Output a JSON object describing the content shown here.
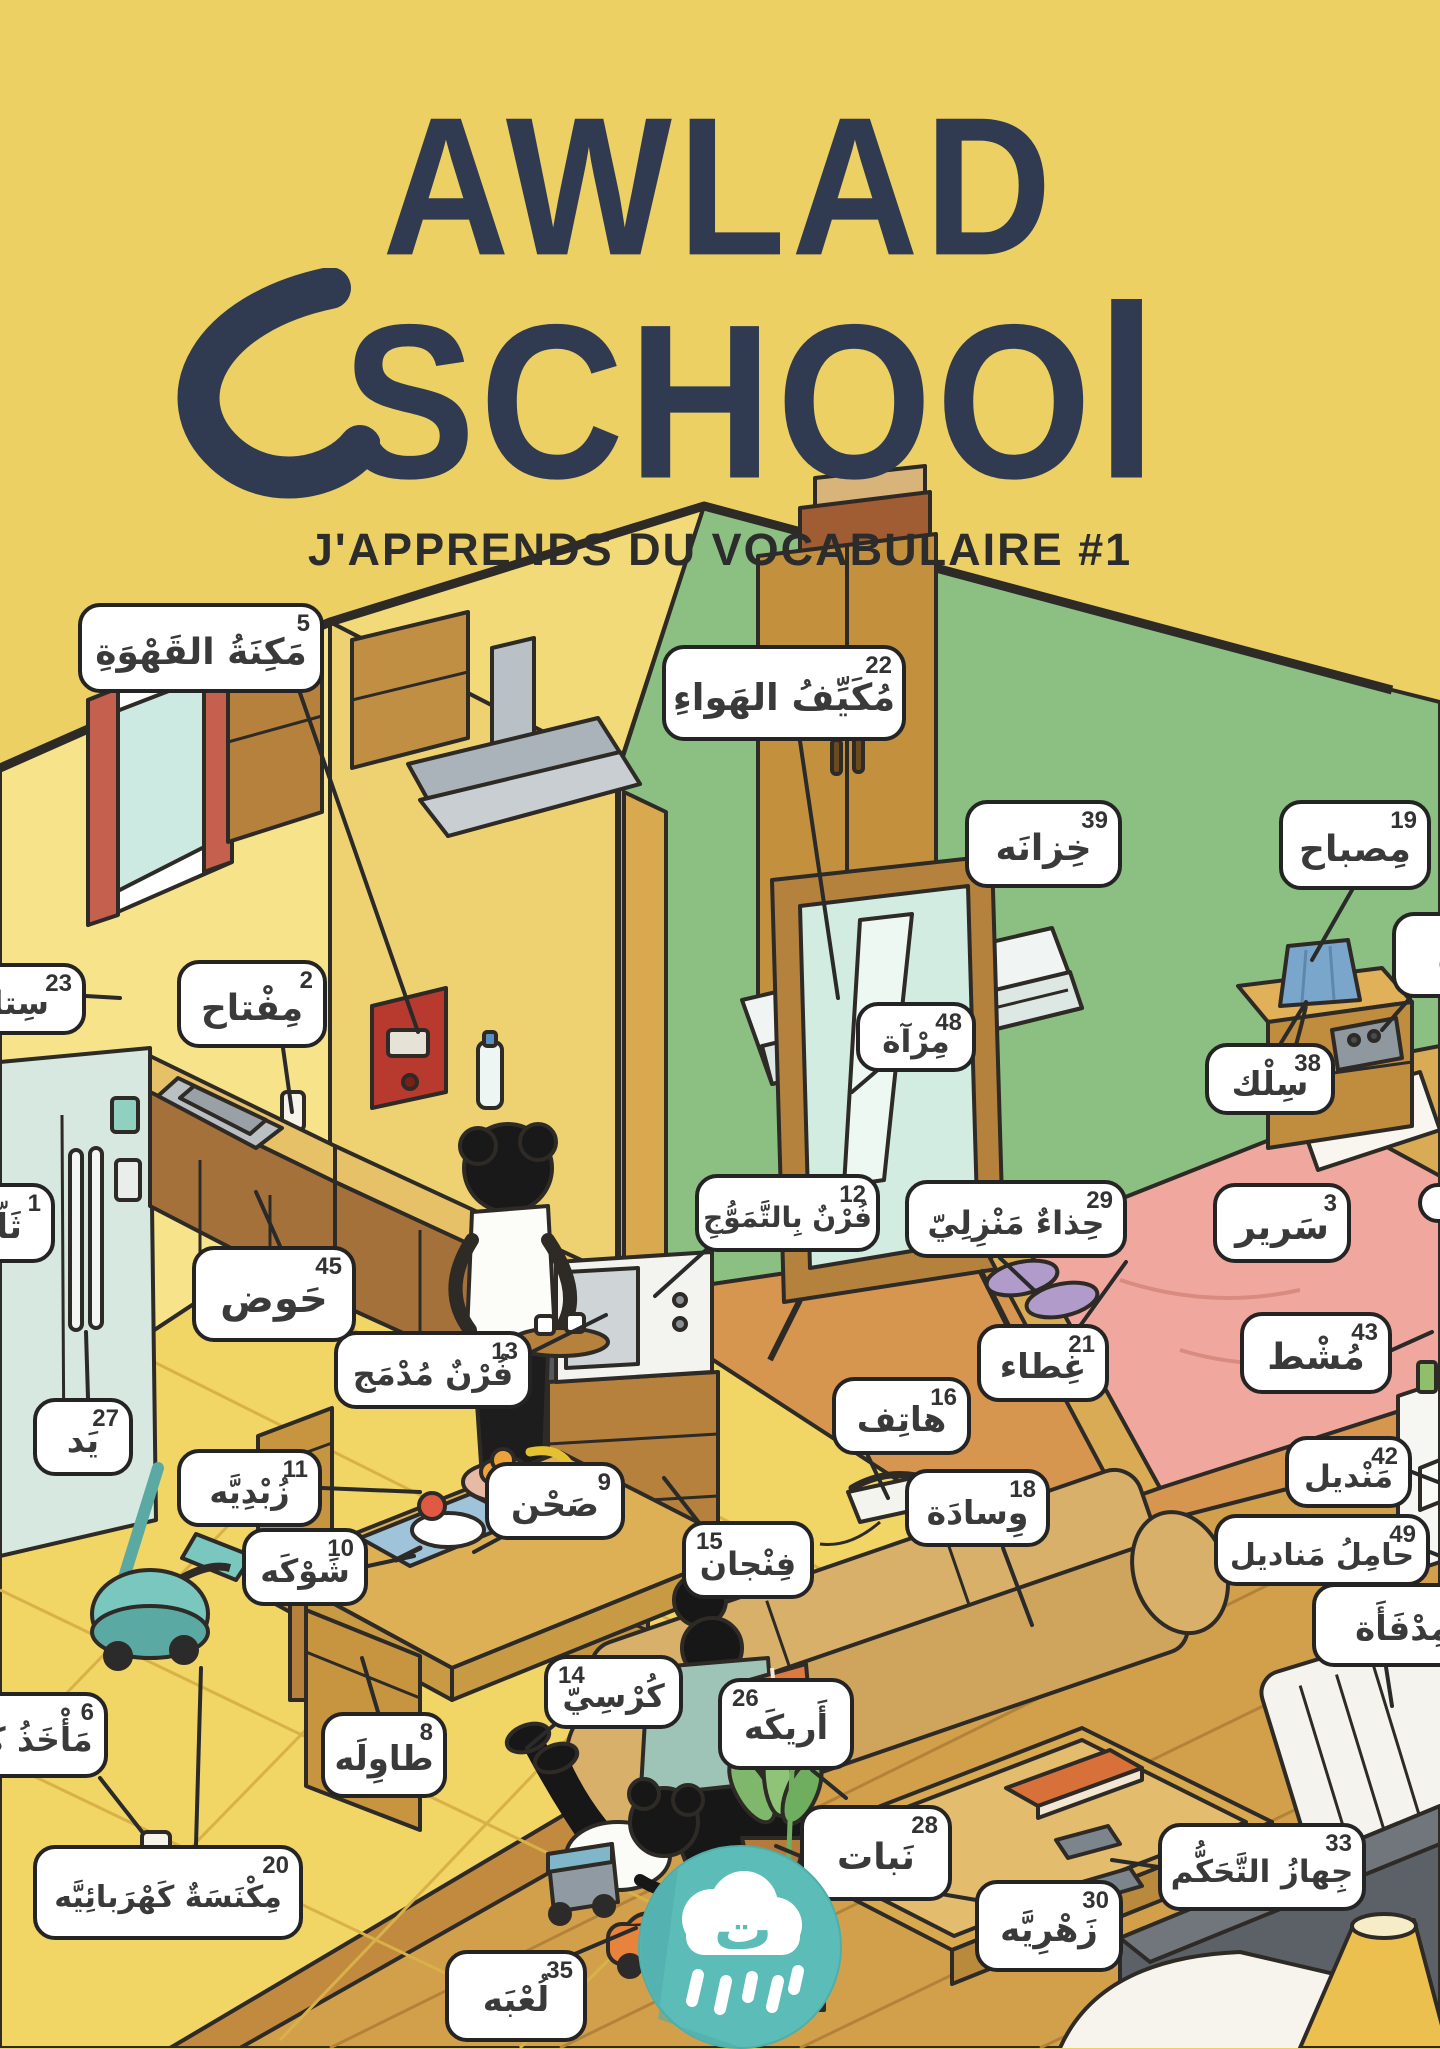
{
  "title": {
    "line1": "AWLAD",
    "line2_prefix": "SCHOO",
    "line2_suffix": "l"
  },
  "subtitle": "J'APPRENDS DU VOCABULAIRE #1",
  "colors": {
    "background": "#ecd063",
    "title_text": "#303b52",
    "green_wall": "#8cbf82",
    "kitchen_wall": "#f7e38a",
    "wood_floor": "#d2a04b",
    "label_bg": "#ffffff",
    "label_border": "#242424",
    "logo_teal": "#5cbcb8"
  },
  "logo": {
    "letter": "ت",
    "icon": "cloud-rain-icon"
  },
  "labels": [
    {
      "name": "fridge",
      "num": "1",
      "text": "ثَلّاجَة",
      "x": -95,
      "y": 1183,
      "w": 150,
      "h": 80,
      "numSide": "right",
      "cut": "left",
      "fs": 34,
      "line": null
    },
    {
      "name": "key",
      "num": "2",
      "text": "مِفْتاح",
      "x": 177,
      "y": 960,
      "w": 150,
      "h": 88,
      "numSide": "right",
      "cut": null,
      "fs": 36,
      "line": [
        283,
        1048,
        292,
        1112
      ]
    },
    {
      "name": "bed",
      "num": "3",
      "text": "سَرير",
      "x": 1213,
      "y": 1183,
      "w": 138,
      "h": 80,
      "numSide": "right",
      "cut": null,
      "fs": 36,
      "line": null
    },
    {
      "name": "coffee-machine",
      "num": "5",
      "text": "مَكِنَةُ القَهْوَةِ",
      "x": 78,
      "y": 603,
      "w": 246,
      "h": 90,
      "numSide": "right",
      "cut": null,
      "fs": 36,
      "line": [
        300,
        693,
        418,
        1032
      ]
    },
    {
      "name": "outlet",
      "num": "6",
      "text": "مَأْخَذُ كَهْـ",
      "x": -62,
      "y": 1692,
      "w": 170,
      "h": 86,
      "numSide": "right",
      "cut": "left",
      "fs": 33,
      "line": [
        100,
        1778,
        143,
        1833
      ]
    },
    {
      "name": "table",
      "num": "8",
      "text": "طاوِلَه",
      "x": 321,
      "y": 1712,
      "w": 126,
      "h": 86,
      "numSide": "right",
      "cut": null,
      "fs": 34,
      "line": [
        378,
        1712,
        362,
        1658
      ]
    },
    {
      "name": "plate",
      "num": "9",
      "text": "صَحْن",
      "x": 485,
      "y": 1462,
      "w": 140,
      "h": 78,
      "numSide": "right",
      "cut": null,
      "fs": 34,
      "line": [
        500,
        1538,
        474,
        1552
      ]
    },
    {
      "name": "fork",
      "num": "10",
      "text": "شَوْكَه",
      "x": 242,
      "y": 1528,
      "w": 126,
      "h": 78,
      "numSide": "right",
      "cut": null,
      "fs": 32,
      "line": [
        368,
        1566,
        414,
        1556
      ]
    },
    {
      "name": "bowl",
      "num": "11",
      "text": "زُبْدِيَّه",
      "x": 177,
      "y": 1449,
      "w": 145,
      "h": 78,
      "numSide": "right",
      "cut": null,
      "fs": 32,
      "line": [
        322,
        1488,
        420,
        1492
      ]
    },
    {
      "name": "microwave-oven",
      "num": "12",
      "text": "فُرْنٌ بِالتَّمَوُّجِ",
      "x": 695,
      "y": 1174,
      "w": 185,
      "h": 78,
      "numSide": "right",
      "cut": null,
      "fs": 28,
      "line": [
        706,
        1250,
        655,
        1296
      ]
    },
    {
      "name": "built-in-oven",
      "num": "13",
      "text": "فُرْنٌ مُدْمَج",
      "x": 334,
      "y": 1331,
      "w": 198,
      "h": 78,
      "numSide": "right",
      "cut": null,
      "fs": 32,
      "line": [
        532,
        1352,
        606,
        1315
      ]
    },
    {
      "name": "chair",
      "num": "14",
      "text": "كُرْسِيّ",
      "x": 544,
      "y": 1655,
      "w": 139,
      "h": 74,
      "numSide": "left",
      "cut": null,
      "fs": 32,
      "line": [
        560,
        1720,
        527,
        1748
      ]
    },
    {
      "name": "cup",
      "num": "15",
      "text": "فِنْجان",
      "x": 682,
      "y": 1521,
      "w": 132,
      "h": 78,
      "numSide": "left",
      "cut": null,
      "fs": 32,
      "line": [
        700,
        1524,
        664,
        1478
      ]
    },
    {
      "name": "phone",
      "num": "16",
      "text": "هاتِف",
      "x": 832,
      "y": 1377,
      "w": 139,
      "h": 78,
      "numSide": "right",
      "cut": null,
      "fs": 34,
      "line": [
        868,
        1456,
        888,
        1498
      ]
    },
    {
      "name": "pillow",
      "num": "18",
      "text": "وِسادَة",
      "x": 905,
      "y": 1469,
      "w": 145,
      "h": 78,
      "numSide": "right",
      "cut": null,
      "fs": 33,
      "line": [
        1003,
        1548,
        1032,
        1625
      ]
    },
    {
      "name": "lamp",
      "num": "19",
      "text": "مِصباح",
      "x": 1279,
      "y": 800,
      "w": 152,
      "h": 90,
      "numSide": "right",
      "cut": null,
      "fs": 36,
      "line": [
        1352,
        890,
        1312,
        960
      ]
    },
    {
      "name": "vacuum-cleaner",
      "num": "20",
      "text": "مِكْنَسَةٌ كَهْرَبائِيَّه",
      "x": 33,
      "y": 1845,
      "w": 270,
      "h": 95,
      "numSide": "right",
      "cut": null,
      "fs": 30,
      "line": [
        196,
        1845,
        201,
        1668
      ]
    },
    {
      "name": "blanket",
      "num": "21",
      "text": "غِطاء",
      "x": 977,
      "y": 1324,
      "w": 132,
      "h": 78,
      "numSide": "right",
      "cut": null,
      "fs": 34,
      "line": [
        1080,
        1326,
        1126,
        1262
      ]
    },
    {
      "name": "air-conditioner",
      "num": "22",
      "text": "مُكَيِّفُ الهَواءِ",
      "x": 662,
      "y": 645,
      "w": 244,
      "h": 96,
      "numSide": "right",
      "cut": null,
      "fs": 37,
      "line": [
        800,
        741,
        838,
        998
      ]
    },
    {
      "name": "curtain",
      "num": "23",
      "text": "سِتارَة",
      "x": -82,
      "y": 963,
      "w": 168,
      "h": 72,
      "numSide": "right",
      "cut": "left",
      "fs": 32,
      "line": [
        86,
        996,
        120,
        998
      ]
    },
    {
      "name": "sofa",
      "num": "26",
      "text": "أَريكَه",
      "x": 718,
      "y": 1678,
      "w": 136,
      "h": 92,
      "numSide": "left",
      "cut": null,
      "fs": 34,
      "line": [
        812,
        1770,
        846,
        1798
      ]
    },
    {
      "name": "hand",
      "num": "27",
      "text": "يَد",
      "x": 33,
      "y": 1398,
      "w": 100,
      "h": 78,
      "numSide": "right",
      "cut": null,
      "fs": 34,
      "line": [
        88,
        1398,
        86,
        1332
      ]
    },
    {
      "name": "plant",
      "num": "28",
      "text": "نَبات",
      "x": 800,
      "y": 1805,
      "w": 152,
      "h": 96,
      "numSide": "right",
      "cut": null,
      "fs": 36,
      "line": [
        800,
        1856,
        776,
        1846
      ]
    },
    {
      "name": "house-slippers",
      "num": "29",
      "text": "حِذاءٌ مَنْزِلِيّ",
      "x": 905,
      "y": 1180,
      "w": 222,
      "h": 78,
      "numSide": "right",
      "cut": null,
      "fs": 32,
      "line": [
        1000,
        1258,
        1036,
        1292
      ]
    },
    {
      "name": "vase",
      "num": "30",
      "text": "زَهْرِيَّه",
      "x": 975,
      "y": 1880,
      "w": 148,
      "h": 92,
      "numSide": "right",
      "cut": null,
      "fs": 34,
      "line": [
        988,
        1902,
        812,
        1872
      ]
    },
    {
      "name": "remote-control",
      "num": "33",
      "text": "جِهازُ التَّحَكُّم",
      "x": 1158,
      "y": 1823,
      "w": 208,
      "h": 88,
      "numSide": "right",
      "cut": null,
      "fs": 31,
      "line": [
        1165,
        1868,
        1112,
        1860
      ]
    },
    {
      "name": "toy",
      "num": "35",
      "text": "لُعْبَه",
      "x": 445,
      "y": 1950,
      "w": 142,
      "h": 92,
      "numSide": "right",
      "cut": null,
      "fs": 34,
      "line": [
        556,
        1962,
        636,
        1928
      ]
    },
    {
      "name": "wire",
      "num": "38",
      "text": "سِلْك",
      "x": 1205,
      "y": 1043,
      "w": 130,
      "h": 72,
      "numSide": "right",
      "cut": null,
      "fs": 33,
      "line": [
        1281,
        1043,
        1306,
        1002
      ]
    },
    {
      "name": "wardrobe",
      "num": "39",
      "text": "خِزانَه",
      "x": 965,
      "y": 800,
      "w": 157,
      "h": 88,
      "numSide": "right",
      "cut": null,
      "fs": 36,
      "line": null
    },
    {
      "name": "tissue",
      "num": "42",
      "text": "مَنْديل",
      "x": 1285,
      "y": 1436,
      "w": 127,
      "h": 72,
      "numSide": "right",
      "cut": null,
      "fs": 31,
      "line": [
        1412,
        1472,
        1438,
        1482
      ]
    },
    {
      "name": "comb",
      "num": "43",
      "text": "مُشْط",
      "x": 1240,
      "y": 1312,
      "w": 152,
      "h": 82,
      "numSide": "right",
      "cut": null,
      "fs": 36,
      "line": [
        1392,
        1350,
        1432,
        1332
      ]
    },
    {
      "name": "sink",
      "num": "45",
      "text": "حَوض",
      "x": 192,
      "y": 1246,
      "w": 164,
      "h": 96,
      "numSide": "right",
      "cut": null,
      "fs": 40,
      "line": [
        280,
        1246,
        256,
        1192
      ]
    },
    {
      "name": "mirror",
      "num": "48",
      "text": "مِرْآة",
      "x": 856,
      "y": 1002,
      "w": 120,
      "h": 70,
      "numSide": "right",
      "cut": null,
      "fs": 31,
      "line": [
        880,
        1068,
        852,
        1092
      ]
    },
    {
      "name": "tissue-holder",
      "num": "49",
      "text": "حامِلُ مَناديل",
      "x": 1214,
      "y": 1514,
      "w": 216,
      "h": 72,
      "numSide": "right",
      "cut": null,
      "fs": 30,
      "line": [
        1430,
        1552,
        1440,
        1556
      ]
    },
    {
      "name": "heater",
      "num": "",
      "text": "مِدْفَأَة",
      "x": 1312,
      "y": 1583,
      "w": 182,
      "h": 84,
      "numSide": "right",
      "cut": "right",
      "fs": 34,
      "line": [
        1386,
        1667,
        1392,
        1706
      ]
    },
    {
      "name": "partial-right",
      "num": "",
      "text": "ه",
      "x": 1392,
      "y": 912,
      "w": 112,
      "h": 86,
      "numSide": "right",
      "cut": "right",
      "fs": 34,
      "line": [
        1410,
        998,
        1382,
        1030
      ]
    },
    {
      "name": "partial-corner",
      "num": "",
      "text": "",
      "x": 1418,
      "y": 1183,
      "w": 60,
      "h": 40,
      "numSide": "right",
      "cut": "right",
      "fs": 20,
      "line": null
    }
  ]
}
